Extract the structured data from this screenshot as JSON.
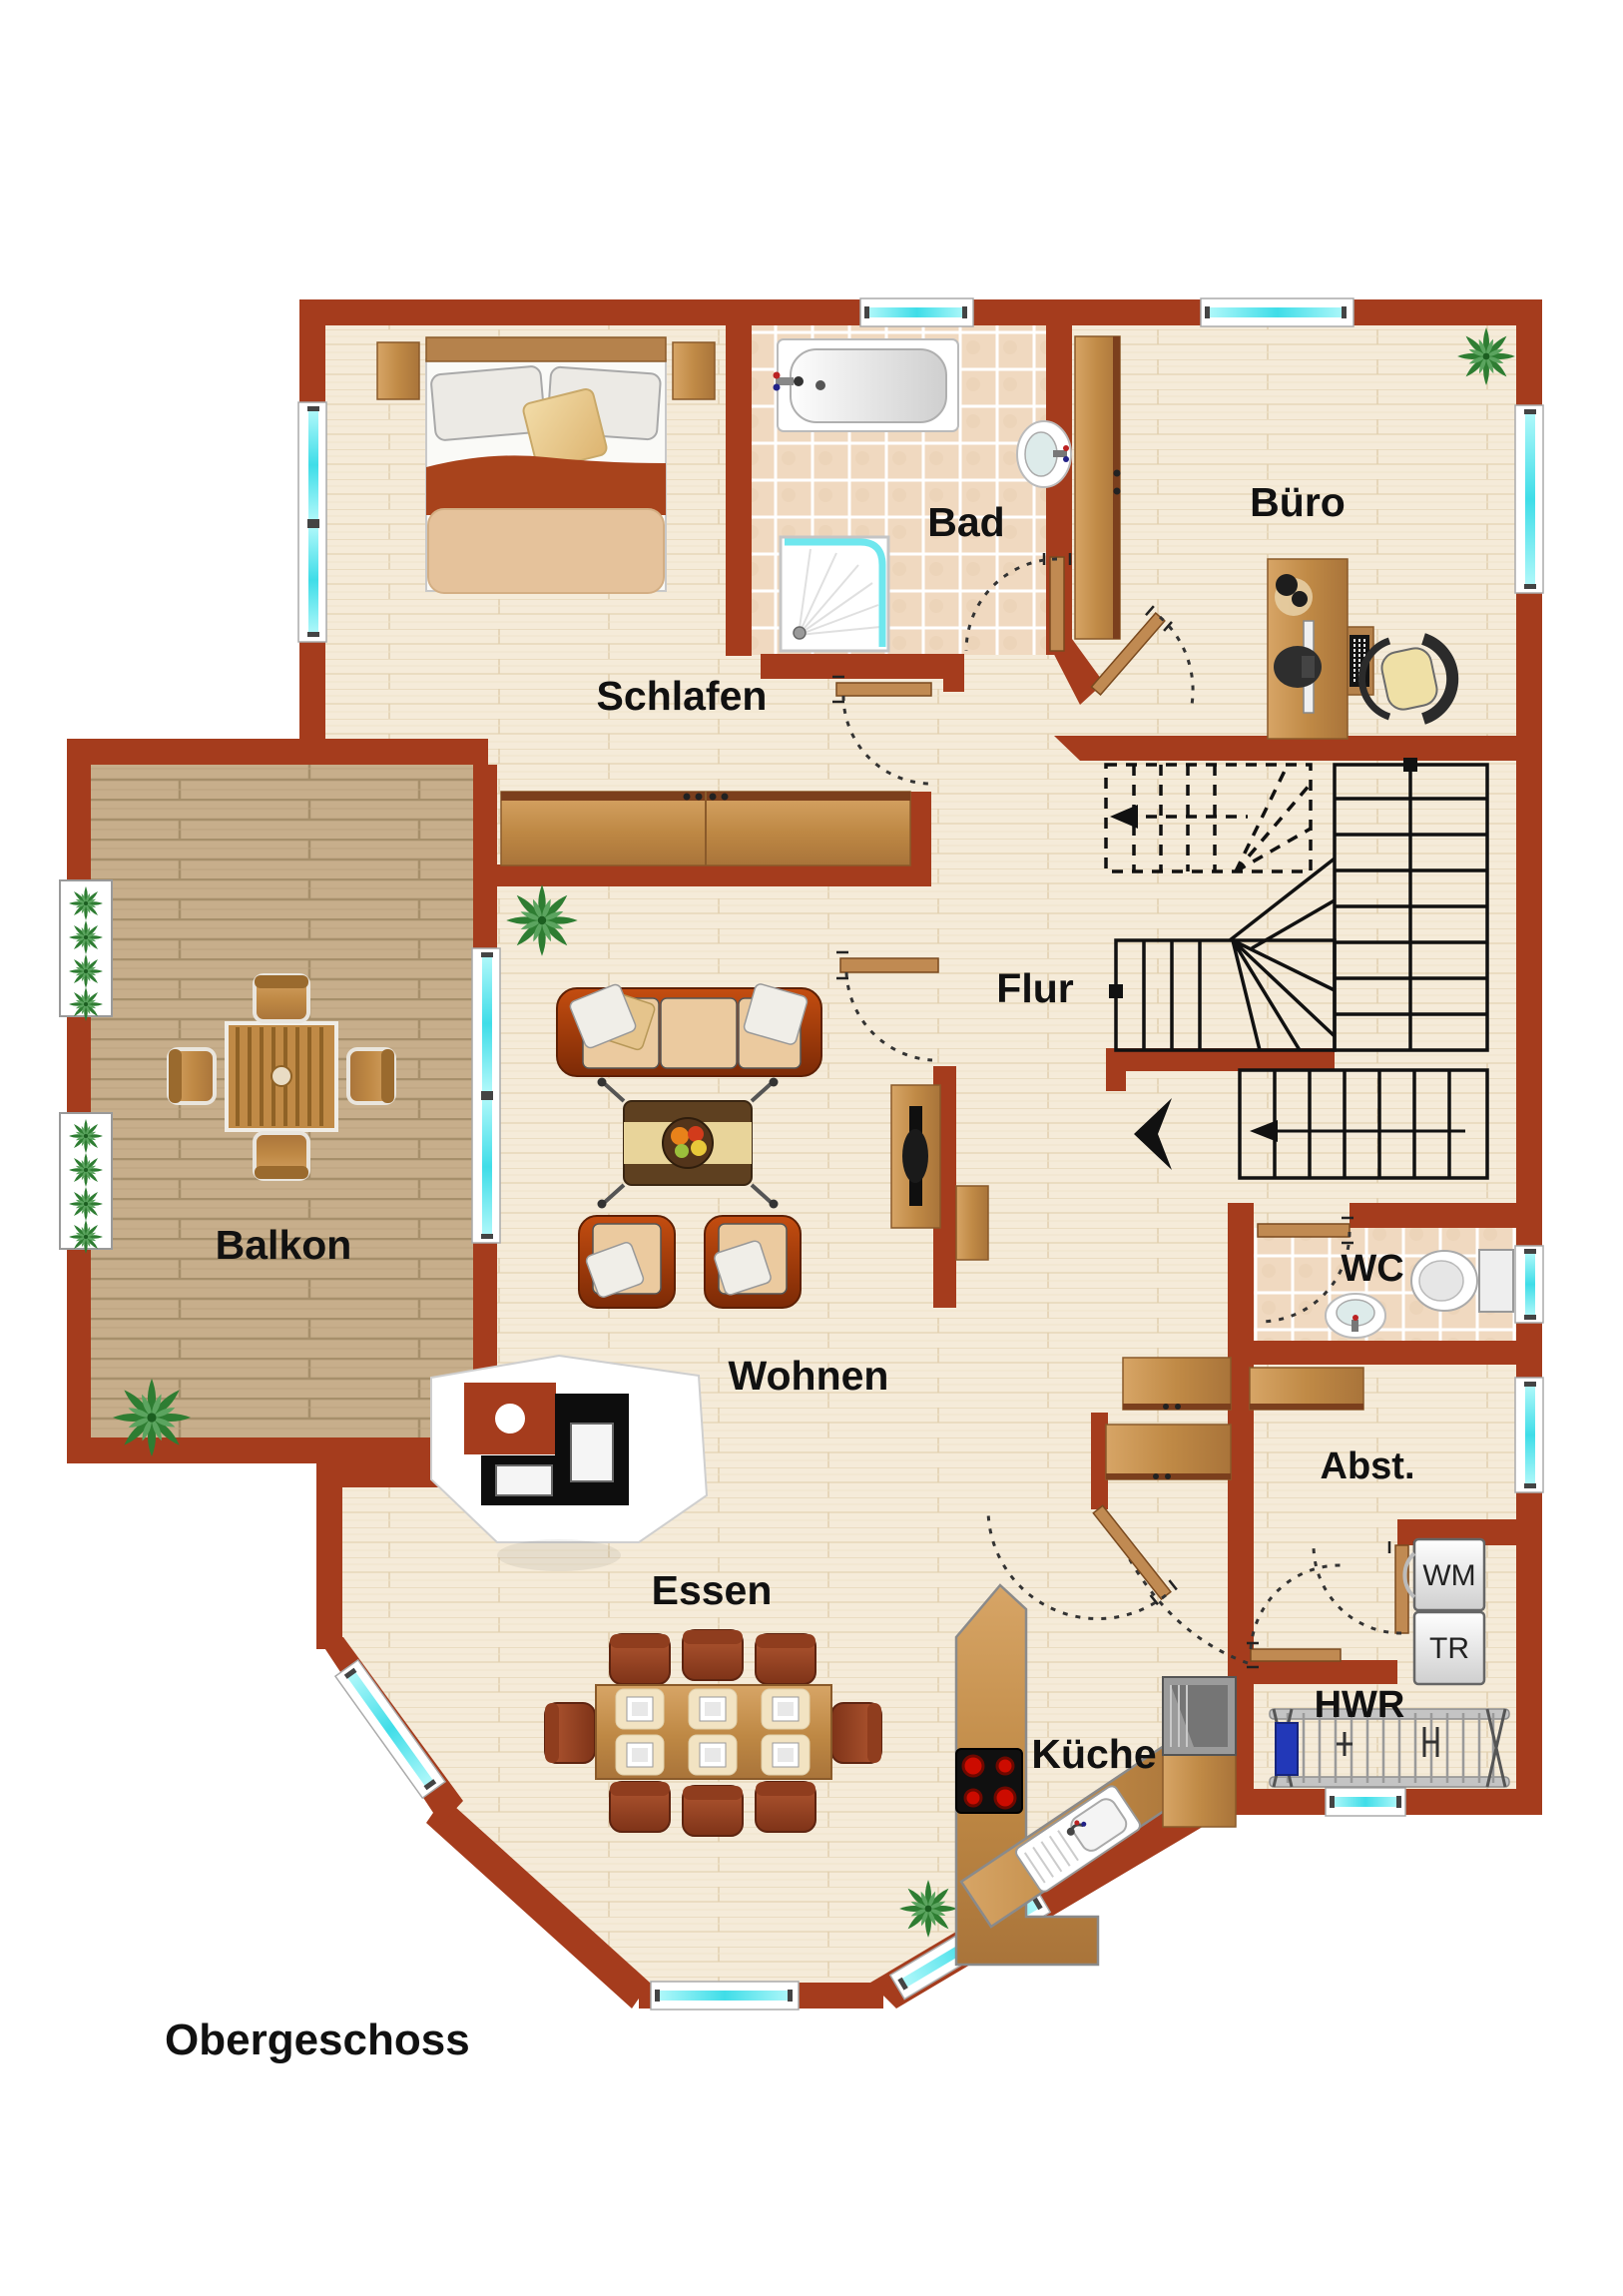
{
  "plan_title": "Obergeschoss",
  "floor_label": "Obergeschoss",
  "rooms": [
    {
      "name": "schlafen",
      "label": "Schlafen"
    },
    {
      "name": "bad",
      "label": "Bad"
    },
    {
      "name": "buero",
      "label": "Büro"
    },
    {
      "name": "flur",
      "label": "Flur"
    },
    {
      "name": "balkon",
      "label": "Balkon"
    },
    {
      "name": "wohnen",
      "label": "Wohnen"
    },
    {
      "name": "wc",
      "label": "WC"
    },
    {
      "name": "abstellraum",
      "label": "Abst."
    },
    {
      "name": "essen",
      "label": "Essen"
    },
    {
      "name": "kueche",
      "label": "Küche"
    },
    {
      "name": "hwr",
      "label": "HWR"
    }
  ],
  "appliances": [
    {
      "name": "washing-machine",
      "label": "WM"
    },
    {
      "name": "dryer",
      "label": "TR"
    }
  ],
  "colors": {
    "wall": "#A53C1D",
    "wood_floor": "#F5EBD9",
    "tile_floor": "#F0D9C0",
    "deck": "#C7AE8B",
    "window_glass": "#5FE5EC",
    "furniture_wood": "#C89254",
    "sofa": "#B03F0E",
    "stair_line": "#111111"
  }
}
